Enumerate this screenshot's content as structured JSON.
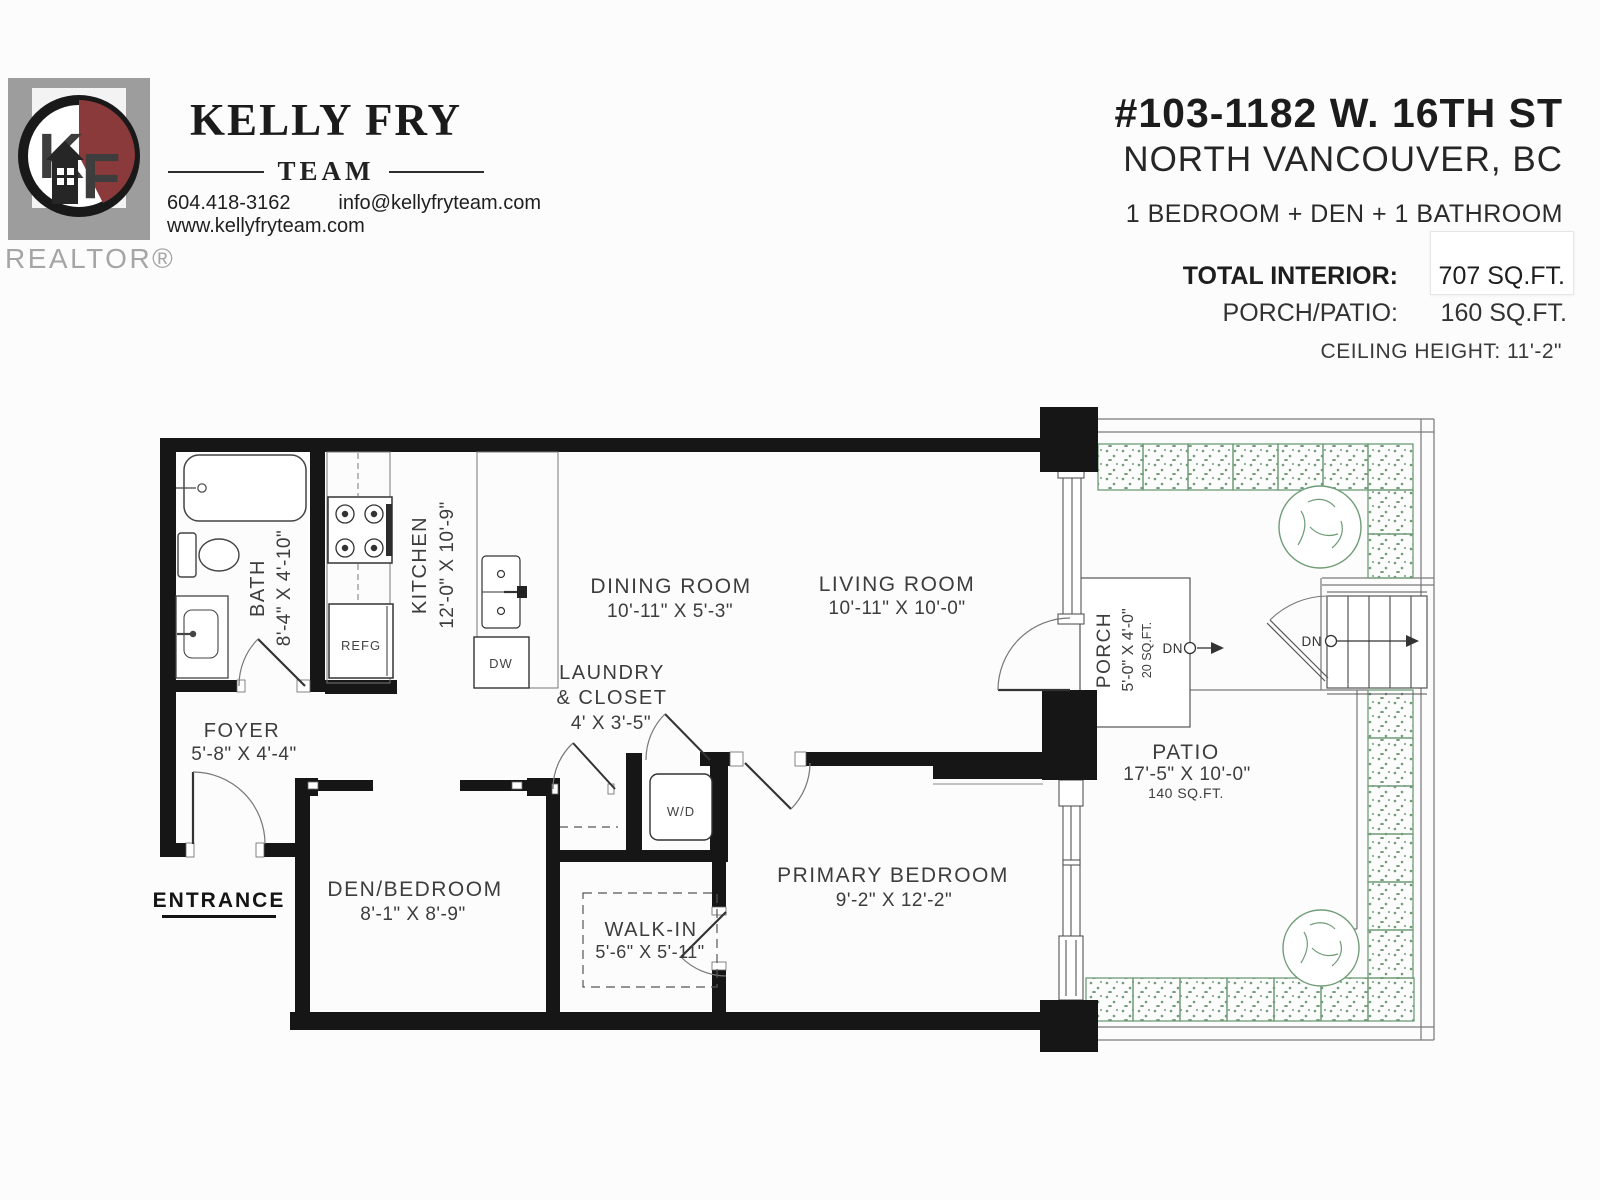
{
  "brand": {
    "team_name": "KELLY FRY",
    "team_word": "TEAM",
    "phone": "604.418-3162",
    "email": "info@kellyfryteam.com",
    "website": "www.kellyfryteam.com",
    "realtor": "REALTOR®",
    "logo_k": "K",
    "logo_f": "F"
  },
  "listing": {
    "address": "#103-1182 W. 16TH ST",
    "city": "NORTH VANCOUVER, BC",
    "summary": "1 BEDROOM + DEN + 1 BATHROOM",
    "total_interior_label": "TOTAL INTERIOR:",
    "total_interior_value": "707 SQ.FT.",
    "porch_patio_label": "PORCH/PATIO:",
    "porch_patio_value": "160 SQ.FT.",
    "ceiling_height": "CEILING HEIGHT: 11'-2\""
  },
  "rooms": {
    "bath": {
      "name": "BATH",
      "dims": "8'-4\" X 4'-10\""
    },
    "kitchen": {
      "name": "KITCHEN",
      "dims": "12'-0\" X 10'-9\""
    },
    "dining": {
      "name": "DINING ROOM",
      "dims": "10'-11\" X 5'-3\""
    },
    "living": {
      "name": "LIVING ROOM",
      "dims": "10'-11\" X 10'-0\""
    },
    "laundry": {
      "line1": "LAUNDRY",
      "line2": "& CLOSET",
      "dims": "4' X 3'-5\""
    },
    "foyer": {
      "name": "FOYER",
      "dims": "5'-8\" X 4'-4\""
    },
    "den": {
      "name": "DEN/BEDROOM",
      "dims": "8'-1\" X 8'-9\""
    },
    "walkin": {
      "name": "WALK-IN",
      "dims": "5'-6\" X 5'-11\""
    },
    "primary": {
      "name": "PRIMARY BEDROOM",
      "dims": "9'-2\" X 12'-2\""
    },
    "porch": {
      "name": "PORCH",
      "dims": "5'-0\" X 4'-0\"",
      "area": "20 SQ.FT."
    },
    "patio": {
      "name": "PATIO",
      "dims": "17'-5\" X 10'-0\"",
      "area": "140 SQ.FT."
    }
  },
  "labels": {
    "entrance": "ENTRANCE",
    "refg": "REFG",
    "dw": "DW",
    "wd": "W/D",
    "dn": "DN"
  },
  "colors": {
    "wall": "#161616",
    "hedge_green": "#6f9c77",
    "logo_maroon": "#8a3a3a",
    "logo_gray": "#9d9d9d"
  }
}
